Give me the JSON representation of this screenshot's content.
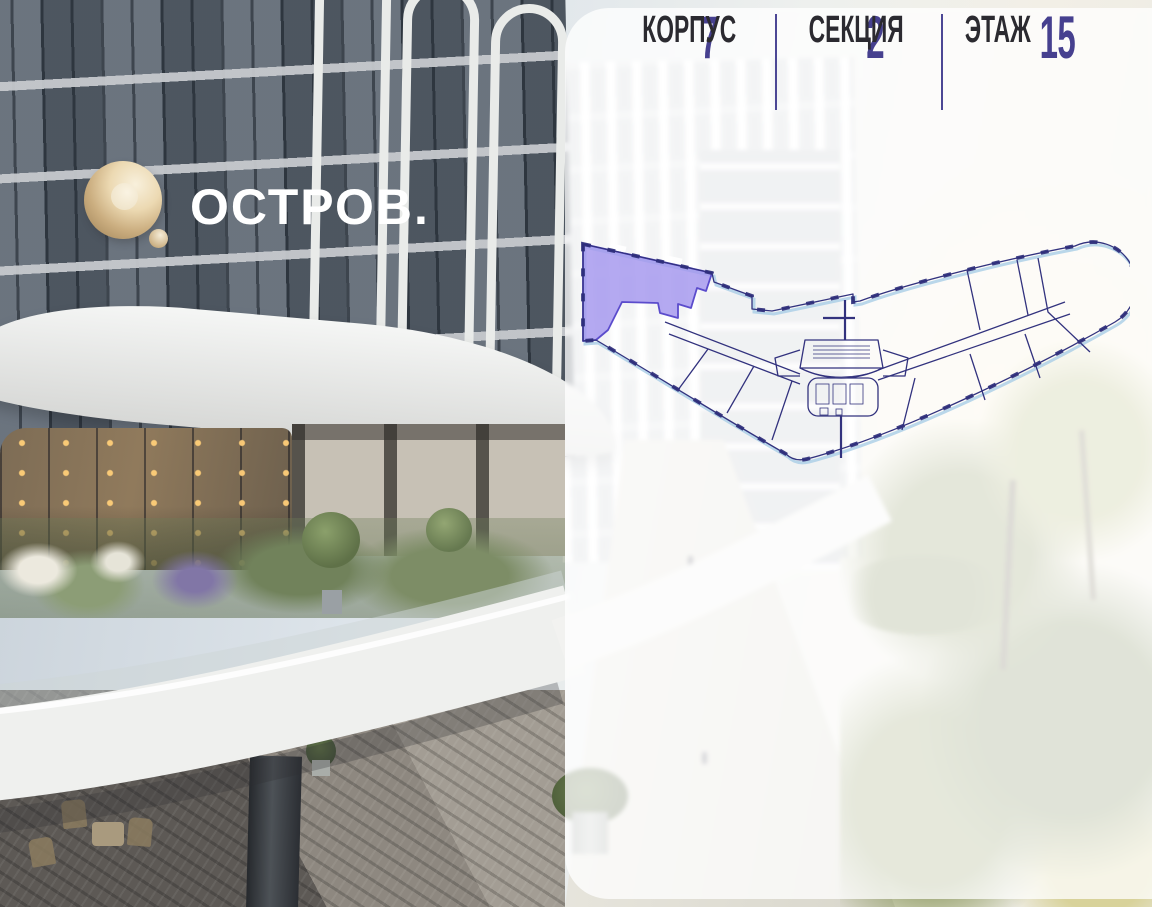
{
  "brand": {
    "logo_text": "ОСТРОВ.",
    "logo_gold_light": "#f2e7cd",
    "logo_gold_dark": "#b2946a"
  },
  "panel": {
    "background_color": "rgba(255,255,255,0.76)",
    "floor_plan": {
      "outline_color": "#32327e",
      "glazing_color": "#a9cde6",
      "highlight_fill": "#a496ee",
      "highlight_stroke": "#5b4ccc"
    },
    "stats": [
      {
        "value": "7",
        "label": "КОРПУС"
      },
      {
        "value": "2",
        "label": "СЕКЦИЯ"
      },
      {
        "value": "15",
        "label": "ЭТАЖ"
      }
    ],
    "value_color": "#46408f",
    "label_color": "#2b2a30",
    "divider_color": "#4c4795"
  }
}
